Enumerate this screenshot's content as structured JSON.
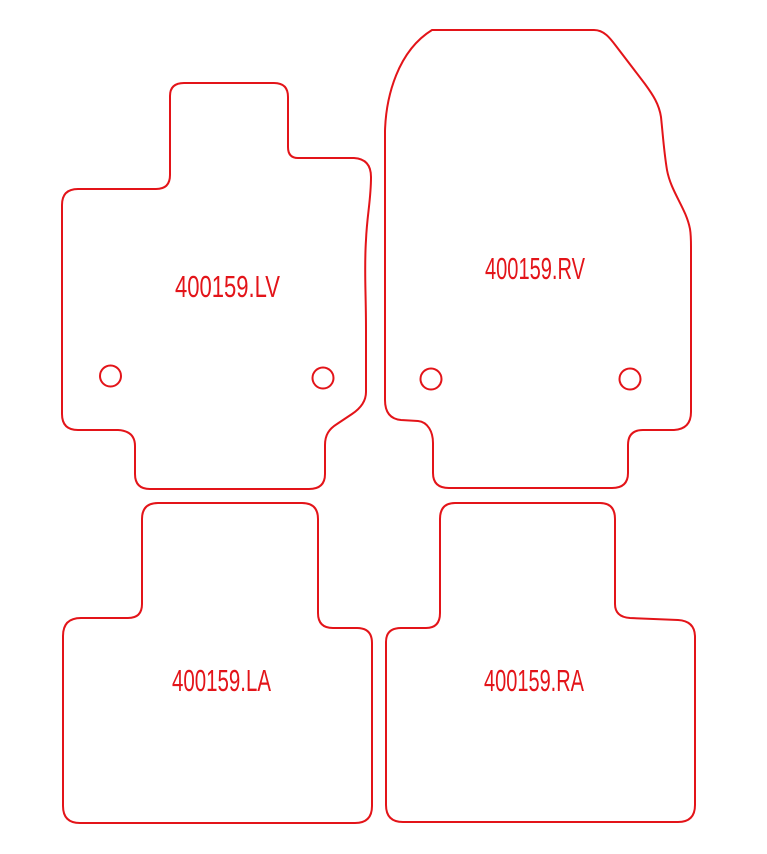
{
  "drawing": {
    "title": "Car mat set cutting pattern 400159",
    "background_color": "#ffffff",
    "line_color": "#e31419",
    "text_color": "#e31419",
    "stroke_width": 2,
    "canvas": {
      "width": 767,
      "height": 854
    }
  },
  "mats": [
    {
      "id": "front-left",
      "label": "400159.LV",
      "label_x": 175,
      "label_y": 297,
      "label_length": 105,
      "path": "M 170 96 L 170 175 Q 170 189 156 189 L 78 189 Q 62 189 62 205 L 62 414 Q 62 430 78 430 L 118 430 Q 135 431 135 446 L 135 474 Q 135 489 150 489 L 309 489 Q 325 489 325 474 L 325 445 C 325 435 329 429 337 424 L 352 414 C 361 408 366 401 366 392 L 366 330 C 366 290 364 270 366 240 C 367 215 371 200 371 177 Q 371 159 354 158 L 298 158 Q 288 158 288 147 L 288 97 Q 288 83 274 83 L 184 83 Q 170 83 170 96 Z",
      "holes": [
        {
          "cx": 110.5,
          "cy": 376,
          "r": 10.5
        },
        {
          "cx": 323,
          "cy": 378,
          "r": 10.5
        }
      ]
    },
    {
      "id": "front-right",
      "label": "400159.RV",
      "label_x": 485,
      "label_y": 279,
      "label_length": 100,
      "path": "M 432 30 L 594 30 C 604 30 610 38 616 46 L 645 84 C 653 95 659 104 661 117 C 663 136 664 152 667 170 C 671 192 686 208 690 229 C 691 235 691 240 691 247 L 691 412 Q 691 429 674 430 L 643 430 Q 628 430 628 445 L 628 473 Q 628 488 612 488 L 449 488 Q 433 488 433 473 L 433 443 C 433 432 428 422 418 421 L 401 420 C 390 419 385 412 385 400 L 385 131 C 386 96 398 51 432 30 Z",
      "holes": [
        {
          "cx": 431,
          "cy": 379,
          "r": 10.5
        },
        {
          "cx": 630,
          "cy": 379,
          "r": 10.5
        }
      ]
    },
    {
      "id": "rear-left",
      "label": "400159.LA",
      "label_x": 172,
      "label_y": 691,
      "label_length": 99,
      "path": "M 142 519 L 142 604 Q 142 618 128 618 L 81 618 Q 63 618 63 636 L 63 806 Q 63 823 80 823 L 355 823 Q 372 823 372 806 L 372 643 Q 372 628 357 628 L 333 628 Q 318 628 318 613 L 318 519 Q 318 503 302 503 L 158 503 Q 142 503 142 519 Z",
      "holes": []
    },
    {
      "id": "rear-right",
      "label": "400159.RA",
      "label_x": 484,
      "label_y": 691,
      "label_length": 100,
      "path": "M 440 519 L 440 613 Q 440 628 426 628 L 401 628 Q 386 628 386 642 L 386 805 Q 386 822 403 822 L 678 822 Q 695 822 695 805 L 695 637 Q 695 621 678 620 L 630 618 Q 615 617 615 604 L 615 519 Q 615 503 600 503 L 455 503 Q 440 503 440 519 Z",
      "holes": []
    }
  ]
}
